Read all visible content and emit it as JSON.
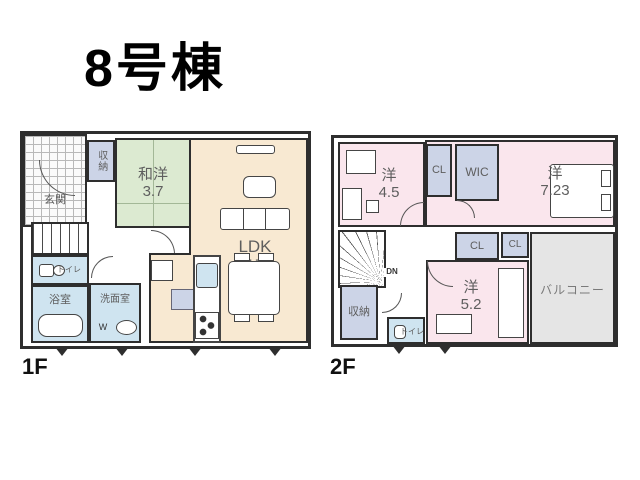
{
  "title": "8号棟",
  "colors": {
    "room_beige": "#f8e9d2",
    "room_green": "#dcead1",
    "room_pink": "#fae6ed",
    "room_blue": "#cfe4f0",
    "closet_lavender": "#ccd4e7",
    "balcony_gray": "#e5e5e5",
    "wall": "#2e2e2e",
    "label_gray": "#5e5e5e"
  },
  "floor1": {
    "label": "1F",
    "genkan": "玄関",
    "shuno": "収納",
    "washitsu": {
      "name": "和洋",
      "size": "3.7"
    },
    "ldk": {
      "name": "LDK",
      "size": "17"
    },
    "toilet": "トイレ",
    "bath": "浴室",
    "senmen": "洗面室",
    "washer": "W"
  },
  "floor2": {
    "label": "2F",
    "yo45": {
      "name": "洋",
      "size": "4.5"
    },
    "cl_top": "CL",
    "wic": "WIC",
    "yo723": {
      "name": "洋",
      "size": "7.23"
    },
    "cl_mid1": "CL",
    "cl_mid2": "CL",
    "yo52": {
      "name": "洋",
      "size": "5.2"
    },
    "shuno": "収納",
    "toilet": "トイレ",
    "balcony": "バルコニー",
    "dn": "DN"
  }
}
